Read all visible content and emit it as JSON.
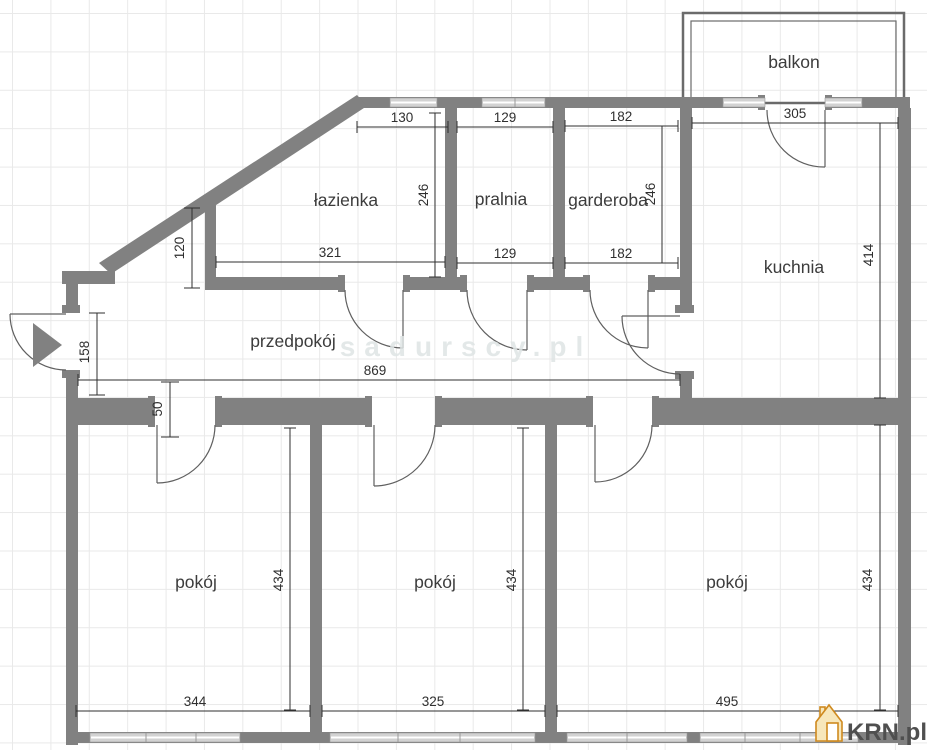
{
  "watermark": "sadurscy.pl",
  "logo": {
    "text": "KRN.pl"
  },
  "rooms": {
    "balkon": "balkon",
    "lazienka": "łazienka",
    "pralnia": "pralnia",
    "garderoba": "garderoba",
    "kuchnia": "kuchnia",
    "przedpokoj": "przedpokój",
    "pokoj_left": "pokój",
    "pokoj_middle": "pokój",
    "pokoj_right": "pokój"
  },
  "dims": {
    "lazienka_top": "130",
    "pralnia_top": "129",
    "garderoba_top": "182",
    "balkon_door": "305",
    "lazienka_height": "246",
    "garderoba_height": "246",
    "kuchnia_height": "414",
    "lazienka_bottom": "321",
    "pralnia_bottom": "129",
    "garderoba_bottom": "182",
    "nook_height": "120",
    "przedpokoj_height": "158",
    "przedpokoj_width": "869",
    "wall_gap": "50",
    "pokoj_left_height": "434",
    "pokoj_middle_height": "434",
    "pokoj_right_height": "434",
    "pokoj_left_width": "344",
    "pokoj_middle_width": "325",
    "pokoj_right_width": "495"
  },
  "colors": {
    "wall": "#818181",
    "door_line": "#5f5f5f",
    "dim_line": "#2f2f2f",
    "label_text": "#3c3c3c",
    "window_fill": "#d2d2d2",
    "watermark_text": "#dfe5e5",
    "balcony_line": "#6b6b6b",
    "logo_text": "#4f4f4f",
    "logo_house_stroke": "#cf8a1f",
    "logo_house_fill": "#f7e7bb"
  }
}
